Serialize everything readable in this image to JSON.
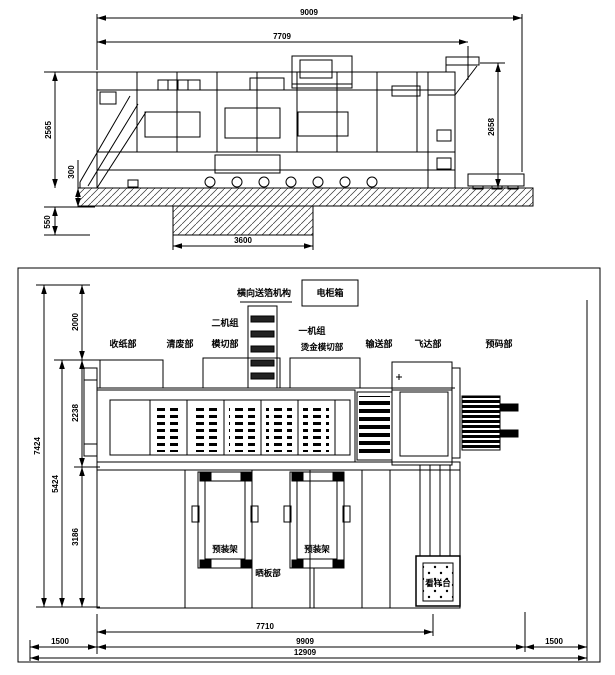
{
  "top_view": {
    "dims": {
      "w_total": "9009",
      "w_inner": "7709",
      "h_left": "2565",
      "h_base": "300",
      "h_pit": "550",
      "h_right": "2658",
      "w_pit": "3600"
    }
  },
  "plan_view": {
    "dims": {
      "seg_top": "2000",
      "seg_mid": "2238",
      "seg_bot": "3186",
      "h_outer": "7424",
      "h_inner": "5424",
      "w_body": "7710",
      "w_machine": "9909",
      "w_left_margin": "1500",
      "w_right_margin": "1500",
      "w_total": "12909"
    },
    "labels": {
      "foil_feed": "横向送箔机构",
      "cabinet": "电柜箱",
      "delivery": "收纸部",
      "stripping": "清废部",
      "unit2_line1": "二机组",
      "unit2_line2": "模切部",
      "unit1_line1": "一机组",
      "unit1_line2": "烫金模切部",
      "convey": "输送部",
      "feeder": "飞达部",
      "prestack": "预码部",
      "rack1": "预装架",
      "rack2": "预装架",
      "plate_section": "晒板部",
      "sample_table": "看样台"
    }
  },
  "colors": {
    "line": "#000000",
    "paper": "#ffffff"
  }
}
